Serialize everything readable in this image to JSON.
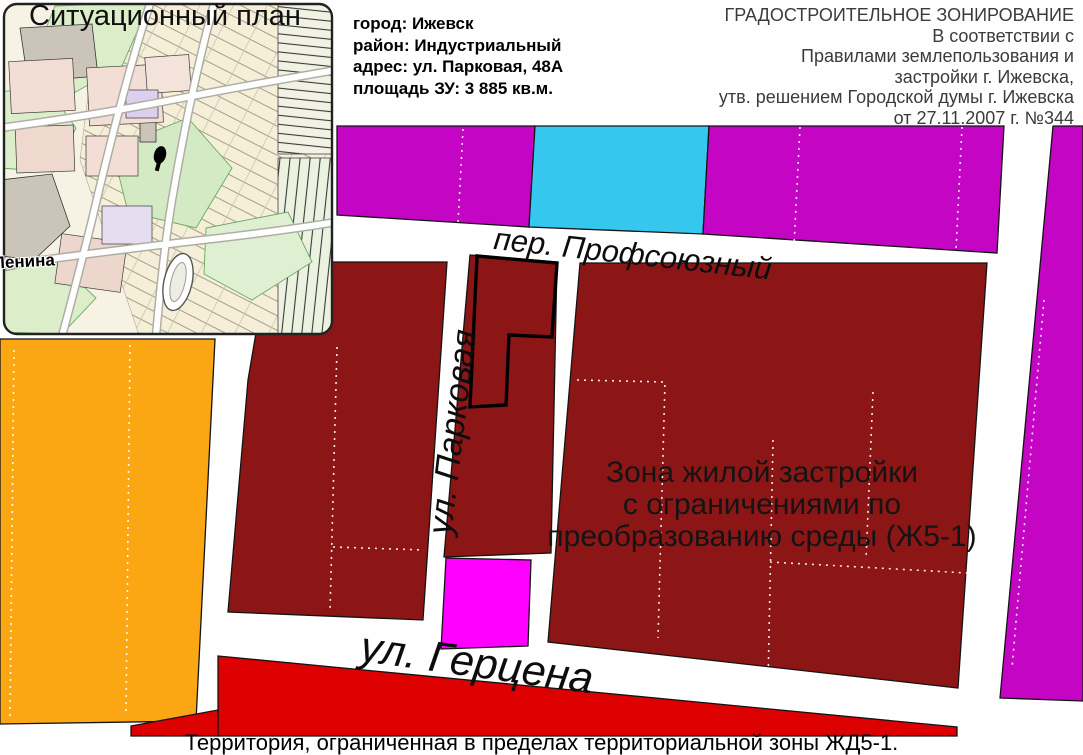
{
  "page": {
    "caption": "Территория, ограниченная в пределах территориальной зоны ЖД5-1."
  },
  "inset_map": {
    "title": "Ситуационный план",
    "street_label": "Ленина"
  },
  "site_info": {
    "lines": [
      "город: Ижевск",
      "район: Индустриальный",
      "адрес: ул. Парковая, 48А",
      "площадь ЗУ: 3 885 кв.м."
    ]
  },
  "zoning_header": {
    "title": "ГРАДОСТРОИТЕЛЬНОЕ ЗОНИРОВАНИЕ",
    "lines": [
      "В соответствии с",
      "Правилами землепользования и",
      "застройки г. Ижевска,",
      "утв. решением Городской думы г. Ижевска",
      "от 27.11.2007 г. №344"
    ]
  },
  "map": {
    "streets": {
      "profsoyuzny": "пер. Профсоюзный",
      "parkovaya": "ул. Парковая",
      "gertsena": "ул. Герцена"
    },
    "zone_label": {
      "line1": "Зона жилой застройки",
      "line2": "с ограничениями по",
      "line3": "преобразованию среды (Ж5-1)"
    }
  },
  "colors": {
    "background": "#FFFFFF",
    "residential_dark_red": "#8C1616",
    "magenta_zone": "#C405C4",
    "cyan_zone": "#35C7EE",
    "pink_zone": "#FF00FF",
    "red_zone": "#DD0000",
    "orange_zone": "#FBA713",
    "parcel_outline": "#000000"
  }
}
